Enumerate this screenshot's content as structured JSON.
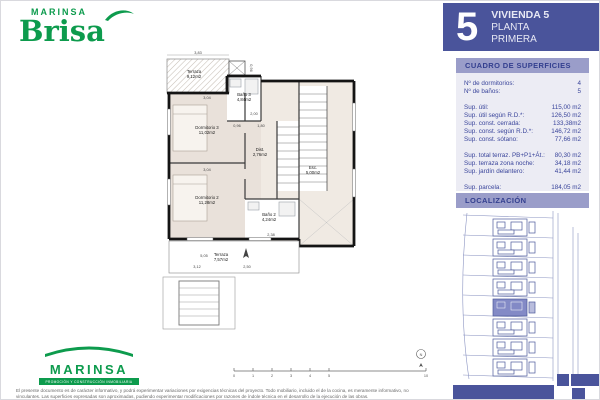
{
  "brand": {
    "top_small": "MARINSA",
    "top_big": "Brisa",
    "bottom_name": "MARINSA",
    "bottom_tagline": "PROMOCIÓN Y CONSTRUCCIÓN INMOBILIARIA"
  },
  "header": {
    "unit_number": "5",
    "line1": "VIVIENDA 5",
    "line2": "PLANTA",
    "line3": "PRIMERA"
  },
  "surfaces": {
    "title": "CUADRO DE SUPERFICIES",
    "rows": [
      {
        "label": "Nº de dormitorios:",
        "value": "4"
      },
      {
        "label": "Nº de baños:",
        "value": "5"
      },
      {
        "label": "Sup. útil:",
        "value": "115,00 m2"
      },
      {
        "label": "Sup. útil según R.D.*:",
        "value": "126,50 m2"
      },
      {
        "label": "Sup. const. cerrada:",
        "value": "133,38m2"
      },
      {
        "label": "Sup. const. según R.D.*:",
        "value": "146,72 m2"
      },
      {
        "label": "Sup. const. sótano:",
        "value": "77,66 m2"
      },
      {
        "label": "Sup. total terraz. PB+P1+Át.:",
        "value": "80,30 m2"
      },
      {
        "label": "Sup. terraza zona noche:",
        "value": "34,18 m2"
      },
      {
        "label": "Sup. jardín delantero:",
        "value": "41,44 m2"
      },
      {
        "label": "Sup. parcela:",
        "value": "184,05 m2"
      }
    ]
  },
  "localizacion": {
    "title": "LOCALIZACIÓN"
  },
  "floorplan": {
    "rooms": {
      "terraza_top": {
        "name": "Terraza",
        "area": "9,12m2"
      },
      "bano3": {
        "name": "Baño 3",
        "area": "4,84m2"
      },
      "dorm3": {
        "name": "Dormitorio 3",
        "area": "11,02m2"
      },
      "dist": {
        "name": "Dist.",
        "area": "2,76m2"
      },
      "esc": {
        "name": "Esc.",
        "area": "5,00m2"
      },
      "dorm2": {
        "name": "Dormitorio 2",
        "area": "11,28m2"
      },
      "bano2": {
        "name": "Baño 2",
        "area": "4,24m2"
      },
      "terraza_bottom": {
        "name": "Terraza",
        "area": "7,57m2"
      }
    },
    "dims": {
      "top_width": "3,83",
      "shaft": "0,96",
      "dorm3_width": "3,04",
      "hall_a": "2,00",
      "hall_b": "0,96",
      "hall_c": "1,80",
      "dorm2_width": "3,04",
      "bano2_width": "2,38",
      "terr_a": "5,05",
      "terr_b": "3,12",
      "terr_c": "2,50"
    },
    "scale_labels": [
      "0",
      "1",
      "2",
      "3",
      "4",
      "5",
      "10"
    ],
    "north_label": "N"
  },
  "footer": {
    "disclaimer1": "El presente documento es de carácter informativo, y podrá experimentar variaciones por exigencias técnicas del proyecto. Todo mobiliario, incluido el de la cocina, es meramente informativo, no",
    "disclaimer2": "vinculantes. Las superficies expresadas son aproximadas, pudiendo experimentar modificaciones por razones de índole técnica en el desarrollo de la ejecución de las obras."
  },
  "colors": {
    "blue": "#4a549b",
    "light_purple": "#9a9dc9",
    "panel_bg": "#ececf4",
    "panel_text": "#3a459b",
    "green": "#0d9b4d",
    "highlight": "#838ac6"
  }
}
